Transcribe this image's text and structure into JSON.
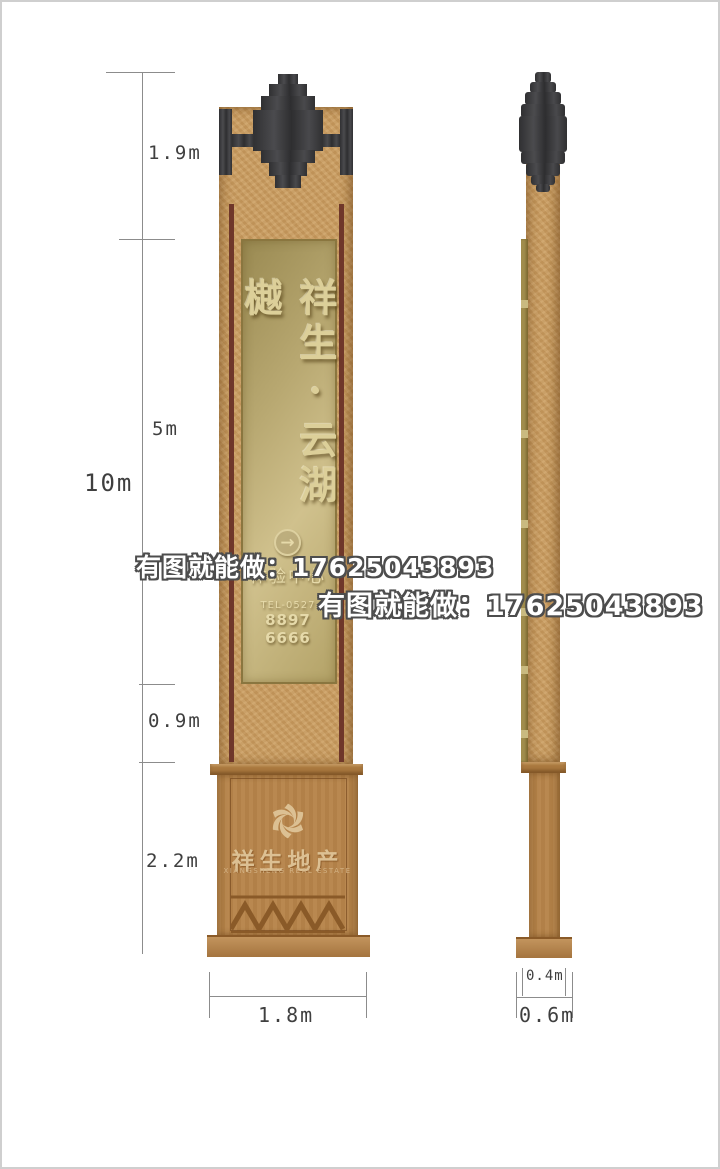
{
  "meta": {
    "drawing_type": "signage pylon elevation drawing",
    "views": [
      "front",
      "side"
    ]
  },
  "watermarks": {
    "primary": "有图就能做：17625043893",
    "secondary": "有图就能做：17625043893"
  },
  "dimensions": {
    "total_height": "10m",
    "segment_finial": "1.9m",
    "segment_sign": "5m",
    "segment_lower": "0.9m",
    "segment_base": "2.2m",
    "front_width": "1.8m",
    "side_cap_width": "0.4m",
    "side_base_width": "0.6m"
  },
  "front_view": {
    "brand_text_vertical": "祥生·云湖樾",
    "arrow_glyph": "→",
    "subtitle": "体验中心",
    "tel_label": "TEL-0527",
    "tel_number": "8897 6666",
    "base_brand": "祥生地产",
    "base_brand_en": "XIANGSHENG REAL ESTATE"
  },
  "icons": {
    "arrow_circle": "arrow-right-circle-icon",
    "base_logo": "xiangsheng-swirl-logo-icon"
  },
  "colors": {
    "column_tan": "#c99c61",
    "finial_dark": "#39393b",
    "strip_maroon": "#6f372a",
    "panel_gold_light": "#d0c18d",
    "panel_gold_dark": "#9a8a52",
    "panel_border": "#8a763f",
    "panel_text_gold": "#dccf99",
    "base_brown": "#b5834a",
    "base_accent": "#8a5a28",
    "base_text": "#dcc093",
    "dim_line": "#8c8c8c",
    "dim_text": "#3f3f3f",
    "watermark_fill": "#ffffff",
    "watermark_outline": "#4d4d4d"
  }
}
